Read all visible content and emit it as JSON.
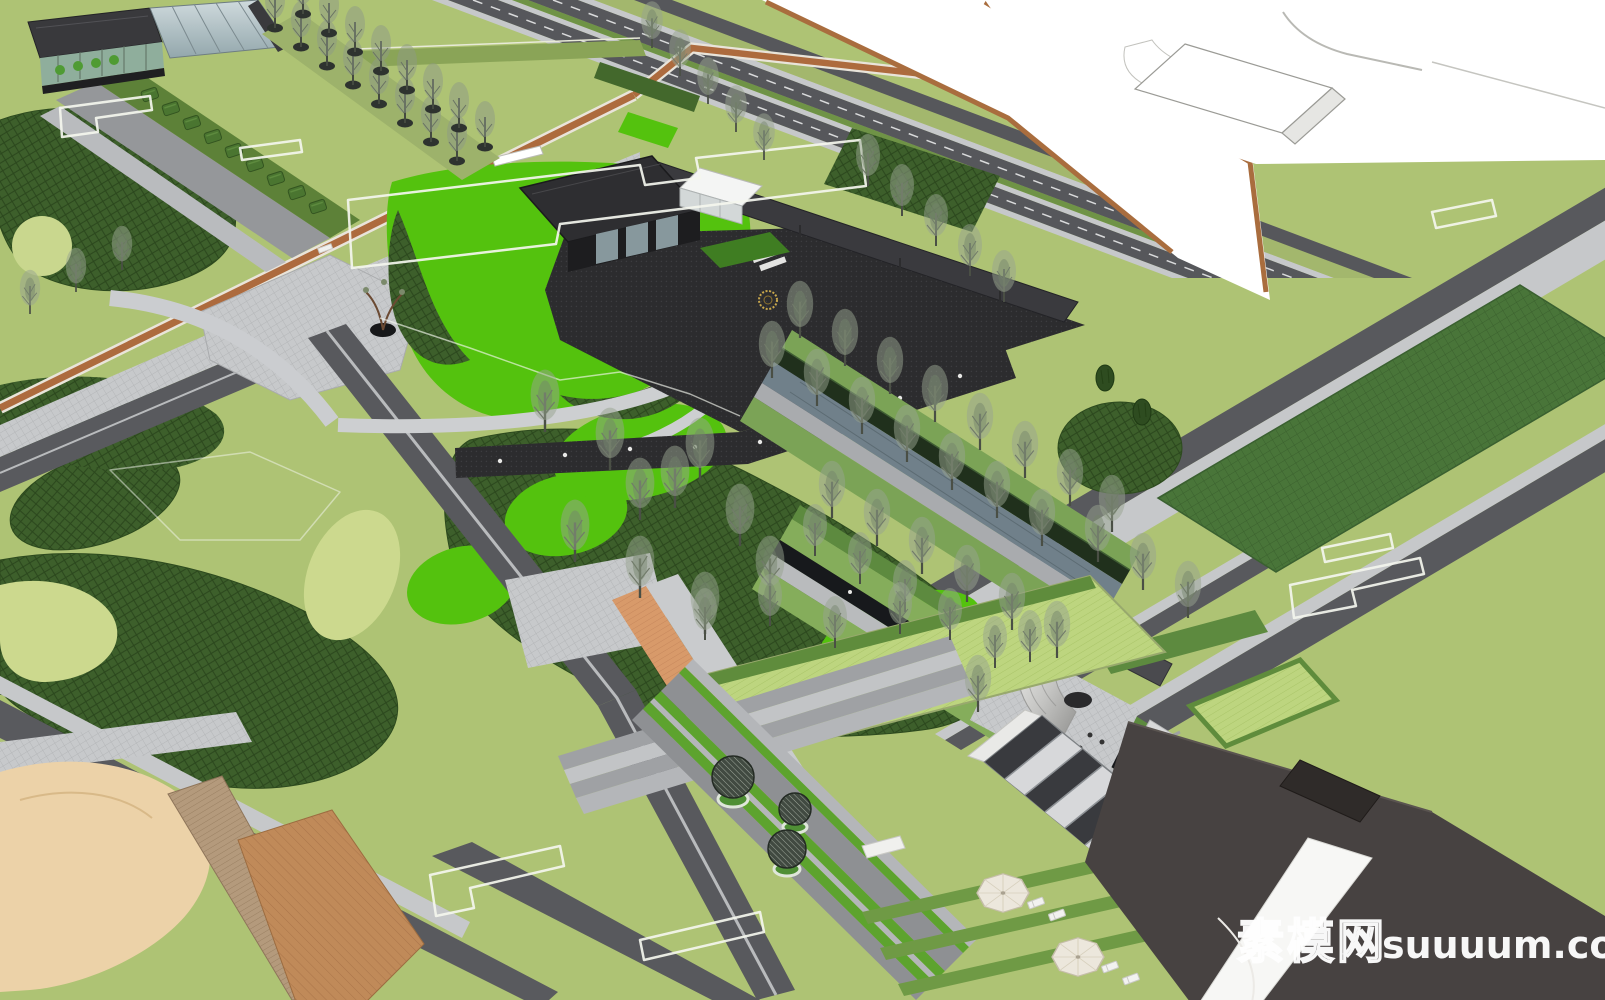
{
  "watermark": {
    "cn": "素模网",
    "domain": "suuuum.com",
    "combined": "素模网suuuum.com",
    "color": "#ffffff"
  },
  "scene": {
    "type": "aerial-3d-landscape-masterplan-render",
    "elements": [
      {
        "name": "visitor-pavilion",
        "label": "dark flat-roof pavilion with glass front and long entry canopy"
      },
      {
        "name": "glass-kiosk",
        "label": "small white glass box pavilion"
      },
      {
        "name": "northwest-building",
        "label": "dark bar building with glass conservatory"
      },
      {
        "name": "tree-allee",
        "label": "double row of bare trees in round planters"
      },
      {
        "name": "central-lawn",
        "label": "bright green lawn with looping grey paths"
      },
      {
        "name": "dark-promenade",
        "label": "black paved walk with inset lights"
      },
      {
        "name": "gold-ring-feature",
        "label": "circular gold paving emblem"
      },
      {
        "name": "water-garden",
        "label": "linear water gardens flanked by bare trees and dark feature walls"
      },
      {
        "name": "sunken-courtyard",
        "label": "sunken court with curved stone waterfall wall"
      },
      {
        "name": "glass-grid-canopy",
        "label": "gridded glass skylight canopy"
      },
      {
        "name": "stepped-walkway",
        "label": "terraced walk with round topiary trees in ring planters"
      },
      {
        "name": "sports-field",
        "label": "dark green rectangular lawn field between roads"
      },
      {
        "name": "jogging-track",
        "label": "orange running track crossing the site"
      },
      {
        "name": "sand-playground",
        "label": "sand play area with timber deck path"
      },
      {
        "name": "umbrella-terrace",
        "label": "lawn terrace with white parasols and loungers"
      },
      {
        "name": "context-massing",
        "label": "white unrendered context blocks and road band"
      },
      {
        "name": "building-outlines",
        "label": "white footprint outlines on lawn"
      }
    ],
    "palette": {
      "lawn_olive": "#aec374",
      "lawn_vivid": "#54c20e",
      "lawn_pale": "#ccd98e",
      "planting_dark": "#3d5f2b",
      "field_green": "#497539",
      "hedge": "#5f8c3c",
      "road_dark": "#58595d",
      "sidewalk": "#c6c8ca",
      "plaza_black": "#2b2b2d",
      "track_orange": "#ad6b3e",
      "deck_tan": "#b49a7c",
      "terracotta": "#c08a59",
      "sand": "#ecd2a8",
      "context_white": "#ffffff",
      "roof_dark": "#474241",
      "glass": "#b9c7cb",
      "water": "#70808a",
      "gold_accent": "#c9a84c"
    }
  }
}
